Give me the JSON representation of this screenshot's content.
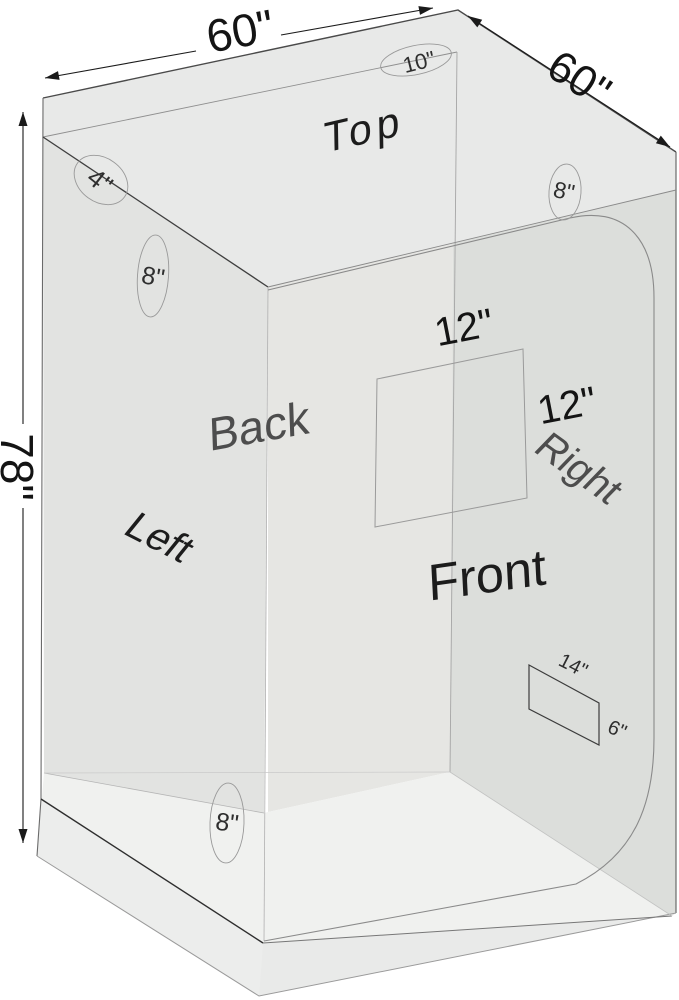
{
  "diagram": {
    "title": "Grow tent dimension diagram",
    "background": "#ffffff",
    "dimensions": {
      "width_top": "60\"",
      "depth_top": "60\"",
      "height_left": "78\""
    },
    "faces": {
      "top": "Top",
      "back": "Back",
      "left": "Left",
      "front": "Front",
      "right": "Right"
    },
    "ports": {
      "top_duct": "10\"",
      "upper_left_duct": "4\"",
      "left_upper_duct": "8\"",
      "front_top_duct": "8\"",
      "left_bottom_duct": "8\""
    },
    "window": {
      "width": "12\"",
      "height": "12\""
    },
    "vent": {
      "width": "14\"",
      "height": "6\""
    },
    "colors": {
      "top_face": "#e8e9e8",
      "left_wall": "#e2e3e1",
      "front_wall": "#e6e6e3",
      "right_wall": "#dcdedb",
      "floor": "#f0f1ef",
      "line_dark": "#2e2e2e",
      "line_light": "#9a9a9a"
    }
  }
}
